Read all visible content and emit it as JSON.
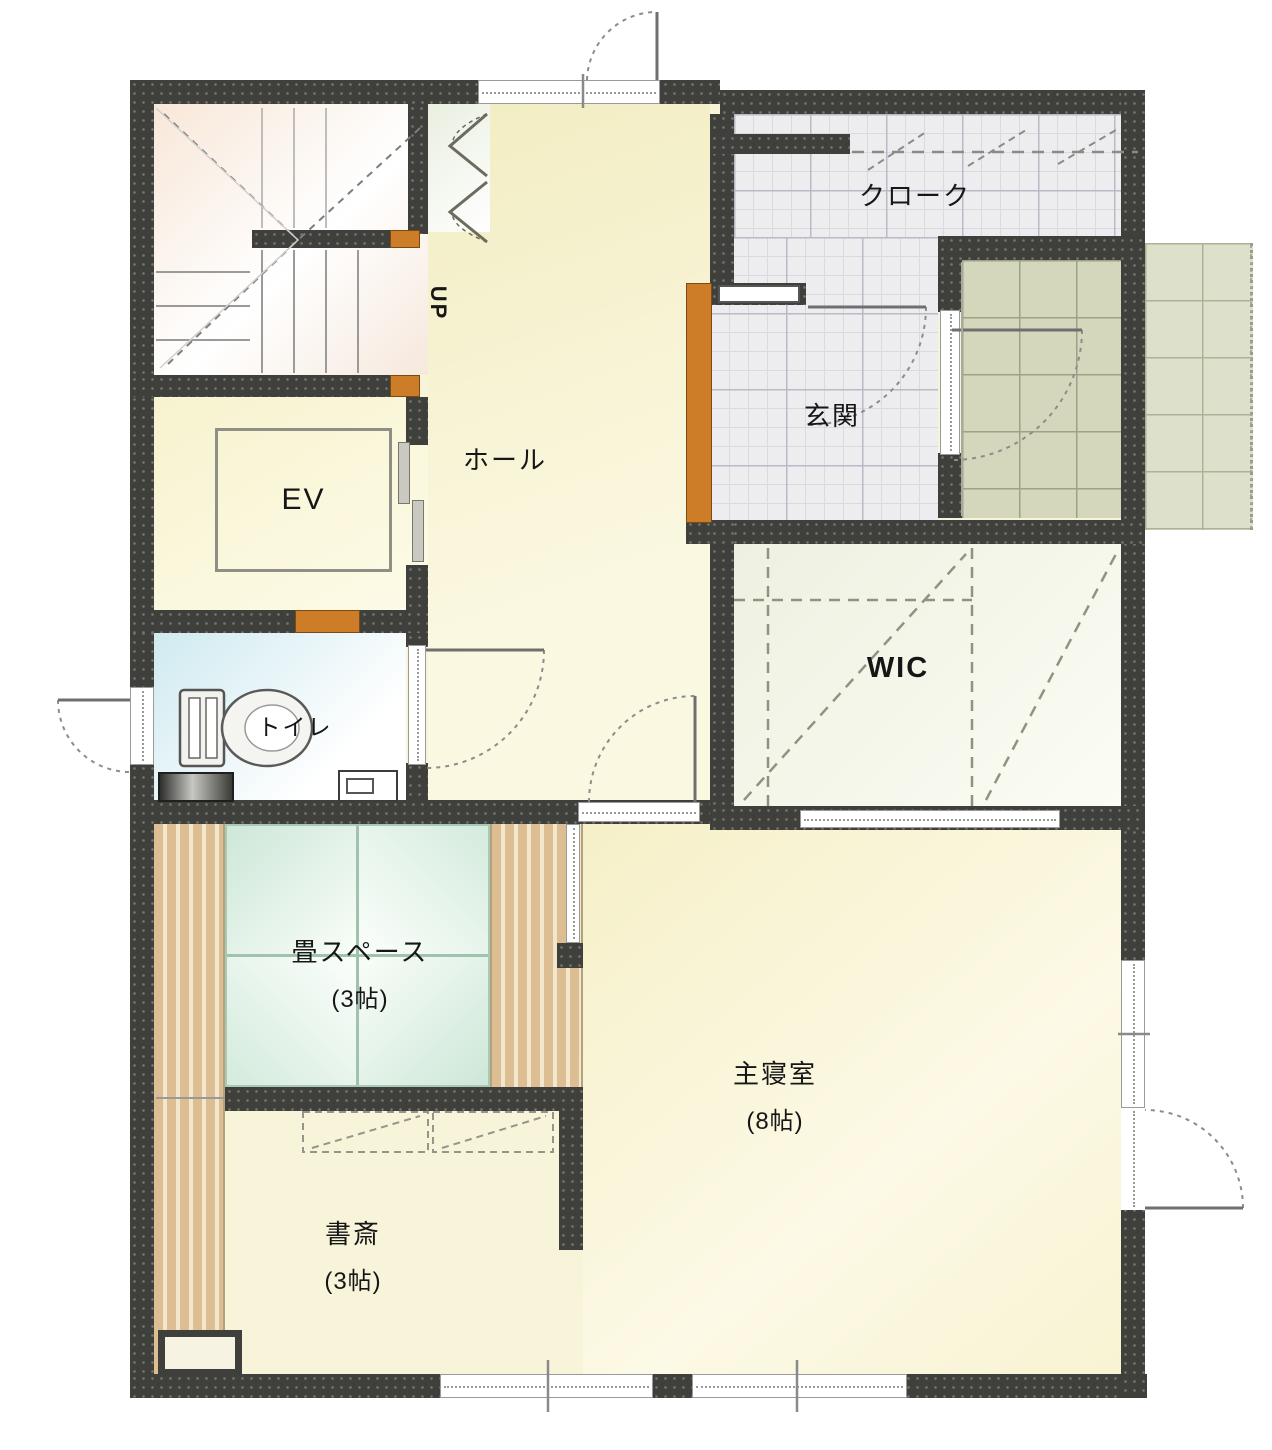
{
  "plan_type": "floor-plan",
  "rooms": {
    "stairs": {
      "direction_label": "UP"
    },
    "hall": {
      "label": "ホール"
    },
    "cloak": {
      "label": "クローク"
    },
    "entrance": {
      "label": "玄関"
    },
    "elevator": {
      "label": "EV"
    },
    "toilet": {
      "label": "トイレ"
    },
    "wic": {
      "label": "WIC"
    },
    "tatami": {
      "label": "畳スペース",
      "size": "(3帖)"
    },
    "study": {
      "label": "書斎",
      "size": "(3帖)"
    },
    "bedroom": {
      "label": "主寝室",
      "size": "(8帖)"
    }
  },
  "colors": {
    "wall": "#3f3f3b",
    "post_accent": "#cd7d28",
    "hall_floor": "#f2edc2",
    "stair_floor": "#f8e7d8",
    "tile_floor": "#ededf0",
    "porch_floor": "#d4d7bc",
    "wic_floor": "#eef1e1",
    "toilet_floor": "#cfeaf0",
    "tatami_floor": "#cde7d8",
    "deck_floor": "#ddbe92",
    "bedroom_floor": "#f6f0c8"
  }
}
